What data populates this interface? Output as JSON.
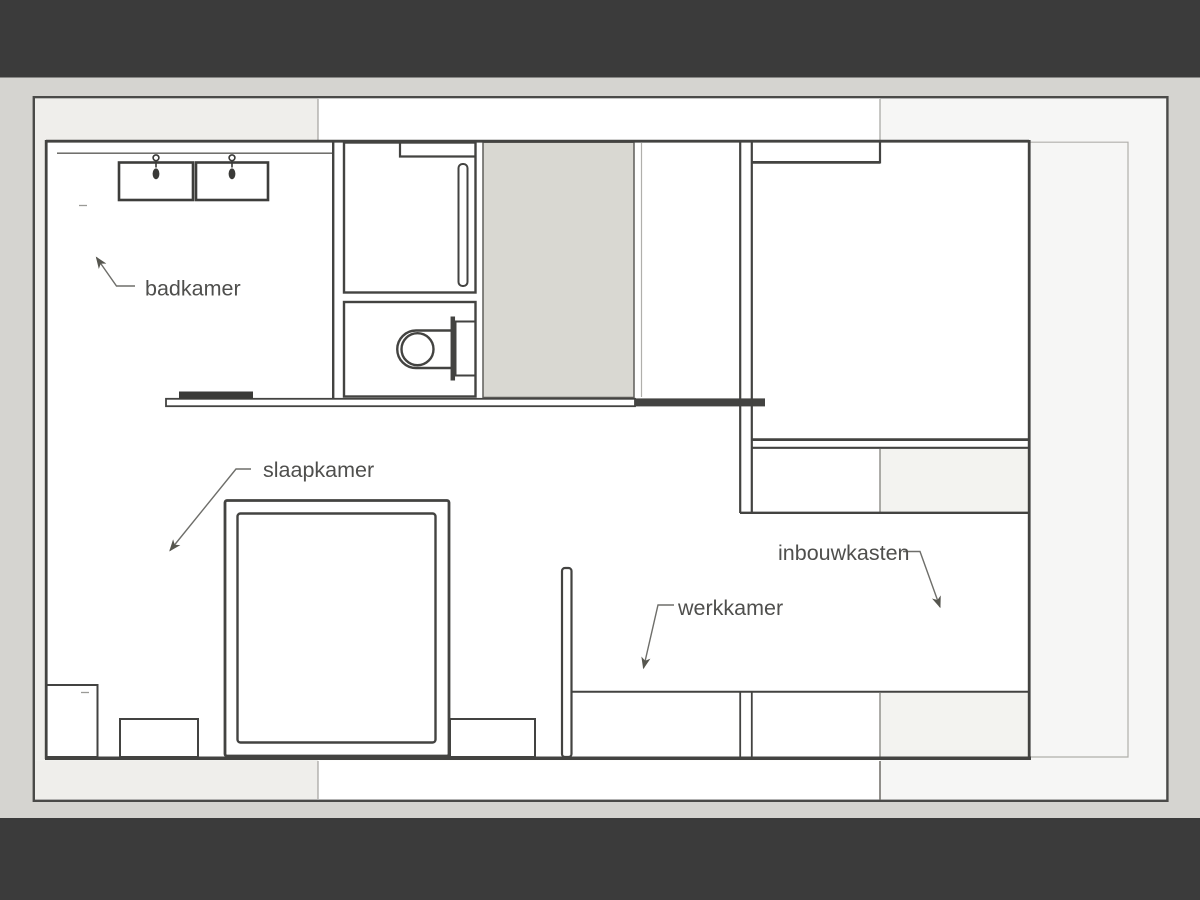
{
  "slide": {
    "kind": "floor-plan-drawing",
    "language": "nl"
  },
  "plan": {
    "annotations": [
      {
        "id": "badkamer",
        "label": "badkamer"
      },
      {
        "id": "slaapkamer",
        "label": "slaapkamer"
      },
      {
        "id": "werkkamer",
        "label": "werkkamer"
      },
      {
        "id": "inbouwkasten",
        "label": "inbouwkasten"
      }
    ]
  },
  "colors": {
    "letterbox": "#3b3b3b",
    "canvas_background": "#d5d4d0",
    "plan_background": "#f6f6f5",
    "strip_gray": "#efeeeb",
    "room_fill": "#ffffff",
    "shaded_zone_fill": "#d9d8d2",
    "inner_strip_gray": "#f3f3f0",
    "wall": "#434341",
    "label_text": "#4f4f4d"
  }
}
